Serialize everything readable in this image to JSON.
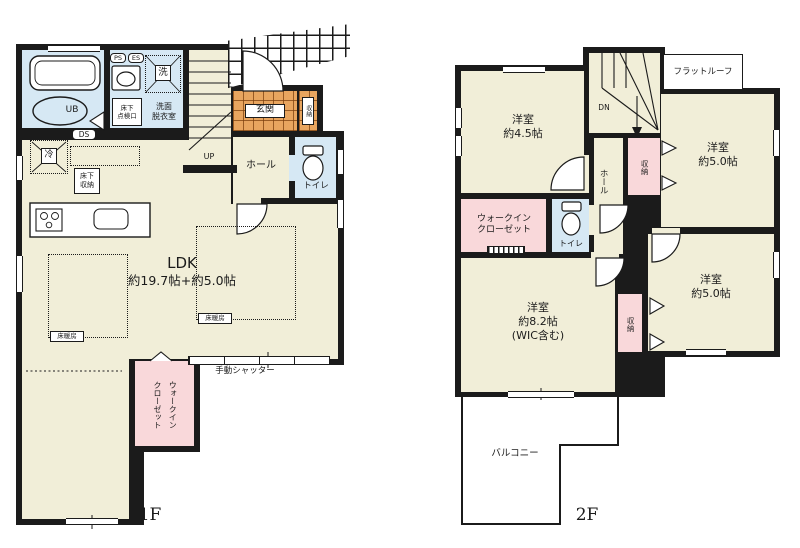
{
  "colors": {
    "wall": "#1b1b1b",
    "floor": "#f1eed8",
    "wet": "#d6e8f4",
    "closet": "#f9d8da",
    "tile_entrance": "#e8a55f"
  },
  "f1": {
    "floor_label": "1F",
    "ldk_title": "LDK",
    "ldk_size": "約19.7帖+約5.0帖",
    "bath": "UB",
    "washroom": "洗面\n脱衣室",
    "laundry": "洗",
    "inspection_hatch": "床下\n点検口",
    "ps": "PS",
    "es": "ES",
    "ds": "DS",
    "fridge": "冷",
    "underfloor_storage": "床下\n収納",
    "up": "UP",
    "hall": "ホール",
    "toilet": "トイレ",
    "entrance": "玄関",
    "entrance_storage": "収納",
    "floor_heating": "床暖房",
    "shutter": "手動シャッター",
    "walkin_closet": "ウォークイン\nクローゼット"
  },
  "f2": {
    "floor_label": "2F",
    "room_nw": "洋室\n約4.5帖",
    "room_ne": "洋室\n約5.0帖",
    "room_main": "洋室\n約8.2帖\n(WIC含む)",
    "room_se": "洋室\n約5.0帖",
    "flat_roof": "フラットルーフ",
    "down": "DN",
    "hall": "ホール",
    "stair_closet": "収納",
    "side_closet": "収納",
    "walkin_closet": "ウォークイン\nクローゼット",
    "toilet": "トイレ",
    "balcony": "バルコニー"
  }
}
